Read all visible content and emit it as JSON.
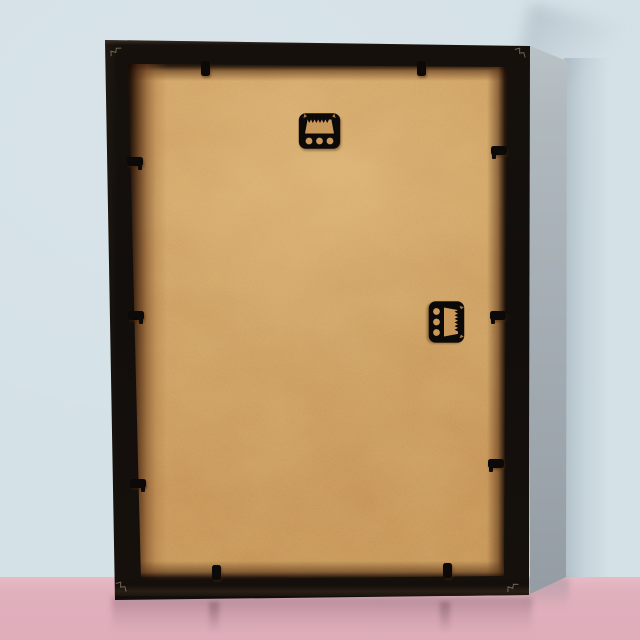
{
  "scene": {
    "description": "Back view of a black wooden picture frame with a tan MDF backing board, leaning against a pale blue wall on a glossy pink floor; black sawtooth hangers and spring clips are mounted on the back",
    "colors": {
      "wall": "#d4e1e7",
      "wall_shadow": "#94a4af",
      "floor": "#dfadba",
      "floor_horizon": "#e6bac5",
      "frame": "#120e0b",
      "frame_side": "#a6afb5",
      "board": "#cf9e5f",
      "board_edge_shadow": "#4a2811",
      "hardware": "#0c0a08",
      "hardware_cutout": "#c9985a",
      "reflection": "#5f3e4b"
    },
    "objects": {
      "frame": {
        "label": "picture frame (back)",
        "material": "black wood"
      },
      "board": {
        "label": "MDF backing board",
        "material": "hardboard"
      },
      "hangers": [
        {
          "label": "sawtooth hanger",
          "orientation": "horizontal",
          "position": "top-center",
          "holes": 3
        },
        {
          "label": "sawtooth hanger",
          "orientation": "vertical",
          "position": "middle-right",
          "holes": 3
        }
      ],
      "clips": {
        "label": "spring clip",
        "top": 2,
        "bottom": 2,
        "left": 3,
        "right": 3,
        "total": 10
      }
    }
  }
}
